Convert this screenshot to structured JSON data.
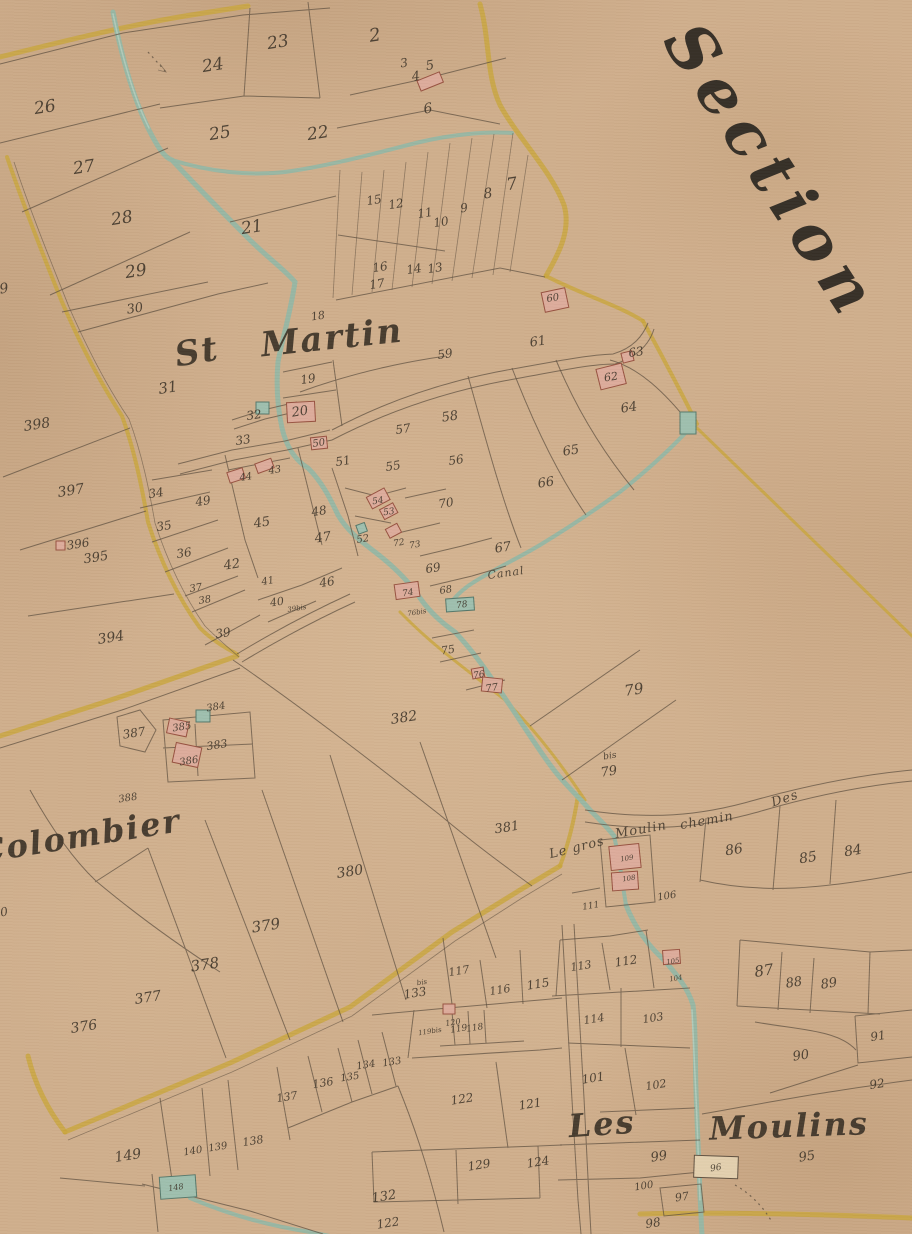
{
  "map": {
    "title": "Section",
    "colors": {
      "paper": "#cfae8c",
      "ink": "#5f5040",
      "ink2": "#3a3126",
      "road": "#c8a53b",
      "water": "#94b6a4",
      "building_pink": "#dcab9b",
      "building_teal": "#9dbfae"
    },
    "place_labels": [
      {
        "t": "St",
        "x": 197,
        "y": 352,
        "s": 34,
        "r": -10,
        "k": "place"
      },
      {
        "t": "Martin",
        "x": 332,
        "y": 338,
        "s": 34,
        "r": -6,
        "k": "place"
      },
      {
        "t": "Colombier",
        "x": 80,
        "y": 836,
        "s": 32,
        "r": -9,
        "k": "place"
      },
      {
        "t": "Les",
        "x": 602,
        "y": 1124,
        "s": 32,
        "r": -4,
        "k": "place"
      },
      {
        "t": "Moulins",
        "x": 789,
        "y": 1126,
        "s": 32,
        "r": -2,
        "k": "place"
      },
      {
        "t": "Le gros",
        "x": 577,
        "y": 848,
        "s": 13,
        "r": -14,
        "k": "road"
      },
      {
        "t": "Moulin",
        "x": 641,
        "y": 830,
        "s": 13,
        "r": -10,
        "k": "road"
      },
      {
        "t": "chemin",
        "x": 707,
        "y": 821,
        "s": 13,
        "r": -10,
        "k": "road"
      },
      {
        "t": "Des",
        "x": 785,
        "y": 799,
        "s": 13,
        "r": -18,
        "k": "road"
      },
      {
        "t": "Canal",
        "x": 506,
        "y": 573,
        "s": 11,
        "r": -8,
        "k": "road"
      }
    ],
    "parcel_labels": [
      [
        "26",
        45,
        108,
        17
      ],
      [
        "27",
        84,
        168,
        17
      ],
      [
        "28",
        122,
        219,
        17
      ],
      [
        "29",
        136,
        272,
        17
      ],
      [
        "30",
        135,
        309,
        13
      ],
      [
        "24",
        213,
        66,
        17
      ],
      [
        "23",
        278,
        43,
        17
      ],
      [
        "25",
        220,
        134,
        17
      ],
      [
        "21",
        252,
        228,
        17
      ],
      [
        "2",
        375,
        36,
        18
      ],
      [
        "3",
        404,
        63,
        12
      ],
      [
        "4",
        416,
        77,
        13
      ],
      [
        "5",
        430,
        66,
        13
      ],
      [
        "6",
        428,
        109,
        14
      ],
      [
        "22",
        318,
        134,
        17
      ],
      [
        "7",
        512,
        185,
        17
      ],
      [
        "8",
        488,
        194,
        14
      ],
      [
        "9",
        464,
        208,
        12
      ],
      [
        "10",
        441,
        222,
        12
      ],
      [
        "11",
        425,
        213,
        12
      ],
      [
        "12",
        396,
        204,
        12
      ],
      [
        "15",
        374,
        200,
        12
      ],
      [
        "16",
        380,
        267,
        12
      ],
      [
        "17",
        377,
        284,
        12
      ],
      [
        "14",
        414,
        269,
        12
      ],
      [
        "13",
        435,
        268,
        12
      ],
      [
        "18",
        318,
        316,
        11
      ],
      [
        "19",
        308,
        379,
        12
      ],
      [
        "31",
        168,
        388,
        15
      ],
      [
        "32",
        254,
        415,
        12
      ],
      [
        "33",
        243,
        440,
        12
      ],
      [
        "20",
        300,
        412,
        13
      ],
      [
        "59",
        445,
        354,
        12
      ],
      [
        "61",
        538,
        342,
        13
      ],
      [
        "63",
        636,
        352,
        12
      ],
      [
        "60",
        553,
        299,
        10
      ],
      [
        "62",
        611,
        377,
        11
      ],
      [
        "64",
        629,
        408,
        13
      ],
      [
        "398",
        37,
        425,
        14
      ],
      [
        "397",
        71,
        491,
        14
      ],
      [
        "396",
        78,
        544,
        12
      ],
      [
        "395",
        96,
        558,
        13
      ],
      [
        "394",
        111,
        638,
        14
      ],
      [
        "9",
        4,
        289,
        14
      ],
      [
        "0",
        4,
        912,
        12
      ],
      [
        "34",
        156,
        493,
        12
      ],
      [
        "49",
        203,
        501,
        12
      ],
      [
        "35",
        164,
        526,
        12
      ],
      [
        "36",
        184,
        553,
        12
      ],
      [
        "37",
        196,
        589,
        10
      ],
      [
        "38",
        205,
        601,
        10
      ],
      [
        "42",
        232,
        565,
        13
      ],
      [
        "39",
        223,
        633,
        12
      ],
      [
        "44",
        246,
        478,
        10
      ],
      [
        "43",
        275,
        471,
        10
      ],
      [
        "45",
        262,
        523,
        13
      ],
      [
        "48",
        319,
        511,
        12
      ],
      [
        "47",
        323,
        538,
        13
      ],
      [
        "46",
        327,
        582,
        12
      ],
      [
        "41",
        268,
        582,
        10
      ],
      [
        "40",
        277,
        602,
        11
      ],
      [
        "39bis",
        297,
        609,
        7
      ],
      [
        "50",
        319,
        444,
        10
      ],
      [
        "51",
        343,
        461,
        12
      ],
      [
        "52",
        363,
        540,
        10
      ],
      [
        "53",
        389,
        513,
        9
      ],
      [
        "54",
        378,
        502,
        9
      ],
      [
        "55",
        393,
        466,
        12
      ],
      [
        "56",
        456,
        460,
        12
      ],
      [
        "57",
        403,
        429,
        12
      ],
      [
        "58",
        450,
        417,
        13
      ],
      [
        "70",
        446,
        503,
        12
      ],
      [
        "72",
        399,
        544,
        9
      ],
      [
        "73",
        415,
        546,
        9
      ],
      [
        "69",
        433,
        568,
        12
      ],
      [
        "67",
        503,
        548,
        13
      ],
      [
        "68",
        446,
        591,
        10
      ],
      [
        "74",
        408,
        594,
        9
      ],
      [
        "78",
        462,
        606,
        9
      ],
      [
        "66",
        546,
        483,
        13
      ],
      [
        "65",
        571,
        451,
        13
      ],
      [
        "75",
        448,
        650,
        11
      ],
      [
        "76",
        479,
        676,
        9
      ],
      [
        "77",
        492,
        689,
        10
      ],
      [
        "76bis",
        417,
        613,
        7
      ],
      [
        "79",
        634,
        690,
        15
      ],
      [
        "bis",
        610,
        757,
        9
      ],
      [
        "79",
        609,
        772,
        13
      ],
      [
        "382",
        404,
        718,
        14
      ],
      [
        "381",
        507,
        828,
        13
      ],
      [
        "380",
        350,
        872,
        14
      ],
      [
        "379",
        266,
        926,
        15
      ],
      [
        "378",
        205,
        965,
        15
      ],
      [
        "377",
        148,
        998,
        14
      ],
      [
        "376",
        84,
        1027,
        14
      ],
      [
        "388",
        128,
        799,
        10
      ],
      [
        "387",
        134,
        733,
        12
      ],
      [
        "385",
        182,
        728,
        10
      ],
      [
        "384",
        216,
        708,
        10
      ],
      [
        "383",
        217,
        745,
        11
      ],
      [
        "386",
        189,
        762,
        10
      ],
      [
        "86",
        734,
        850,
        14
      ],
      [
        "85",
        808,
        858,
        14
      ],
      [
        "84",
        853,
        851,
        14
      ],
      [
        "87",
        764,
        971,
        15
      ],
      [
        "88",
        794,
        983,
        13
      ],
      [
        "89",
        829,
        984,
        13
      ],
      [
        "91",
        878,
        1036,
        12
      ],
      [
        "90",
        801,
        1056,
        13
      ],
      [
        "92",
        877,
        1084,
        12
      ],
      [
        "109",
        627,
        859,
        7
      ],
      [
        "108",
        629,
        879,
        7
      ],
      [
        "106",
        667,
        897,
        10
      ],
      [
        "111",
        591,
        907,
        9
      ],
      [
        "113",
        581,
        966,
        11
      ],
      [
        "112",
        626,
        961,
        12
      ],
      [
        "105",
        673,
        962,
        7
      ],
      [
        "104",
        676,
        979,
        7
      ],
      [
        "114",
        594,
        1019,
        11
      ],
      [
        "103",
        653,
        1018,
        11
      ],
      [
        "101",
        593,
        1078,
        12
      ],
      [
        "102",
        656,
        1085,
        11
      ],
      [
        "99",
        659,
        1157,
        13
      ],
      [
        "100",
        644,
        1187,
        10
      ],
      [
        "95",
        807,
        1157,
        13
      ],
      [
        "96",
        716,
        1169,
        9
      ],
      [
        "97",
        682,
        1197,
        11
      ],
      [
        "98",
        653,
        1223,
        12
      ],
      [
        "117",
        459,
        971,
        11
      ],
      [
        "116",
        500,
        990,
        11
      ],
      [
        "115",
        538,
        984,
        12
      ],
      [
        "bis",
        422,
        983,
        7
      ],
      [
        "133",
        415,
        993,
        12
      ],
      [
        "119bis",
        430,
        1032,
        7
      ],
      [
        "119",
        459,
        1030,
        9
      ],
      [
        "118",
        475,
        1029,
        9
      ],
      [
        "120",
        453,
        1023,
        8
      ],
      [
        "133",
        392,
        1063,
        10
      ],
      [
        "134",
        366,
        1066,
        10
      ],
      [
        "135",
        350,
        1078,
        10
      ],
      [
        "136",
        323,
        1083,
        11
      ],
      [
        "137",
        287,
        1097,
        11
      ],
      [
        "138",
        253,
        1141,
        11
      ],
      [
        "139",
        218,
        1148,
        10
      ],
      [
        "140",
        193,
        1152,
        10
      ],
      [
        "149",
        128,
        1156,
        14
      ],
      [
        "148",
        176,
        1188,
        8
      ],
      [
        "122",
        462,
        1099,
        12
      ],
      [
        "121",
        530,
        1104,
        12
      ],
      [
        "129",
        479,
        1165,
        12
      ],
      [
        "124",
        538,
        1162,
        12
      ],
      [
        "132",
        384,
        1197,
        13
      ],
      [
        "122",
        388,
        1223,
        12
      ]
    ]
  }
}
